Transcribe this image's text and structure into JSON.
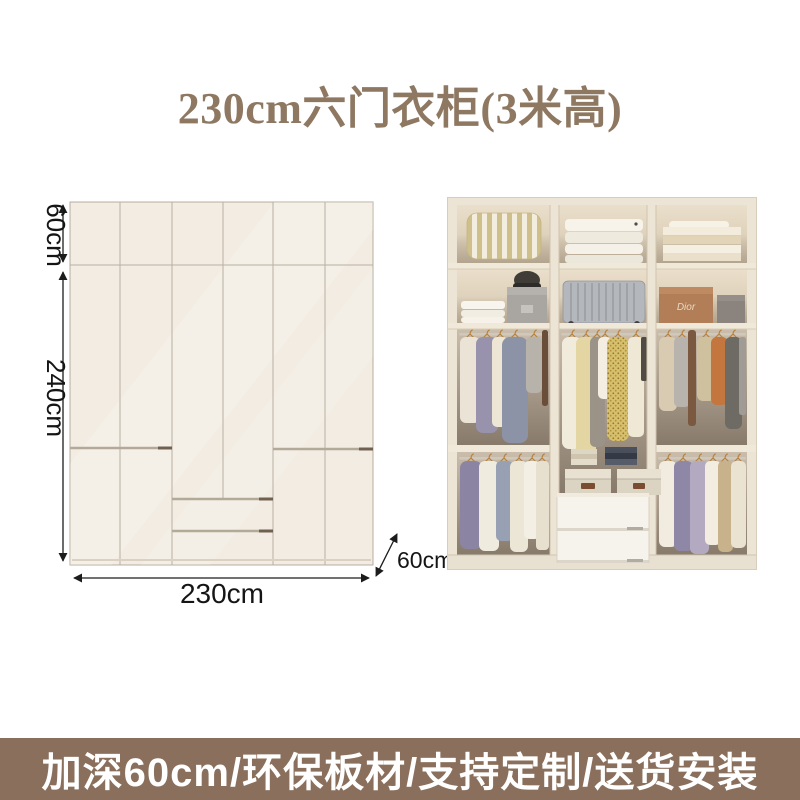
{
  "header": {
    "title": "230cm六门衣柜(3米高)"
  },
  "diagram": {
    "top_height": "60cm",
    "body_height": "240cm",
    "width": "230cm",
    "depth": "60cm"
  },
  "photo": {
    "brand_box_label": "Dior"
  },
  "banner": {
    "text": "加深60cm/环保板材/支持定制/送货安装"
  },
  "colors": {
    "title_text": "#8e7862",
    "banner_bg": "#8a6f5c",
    "banner_text": "#ffffff",
    "cabinet_face": "#f2ece2",
    "panel_line": "#b6ada0",
    "dimension_line": "#1c1c1c"
  }
}
